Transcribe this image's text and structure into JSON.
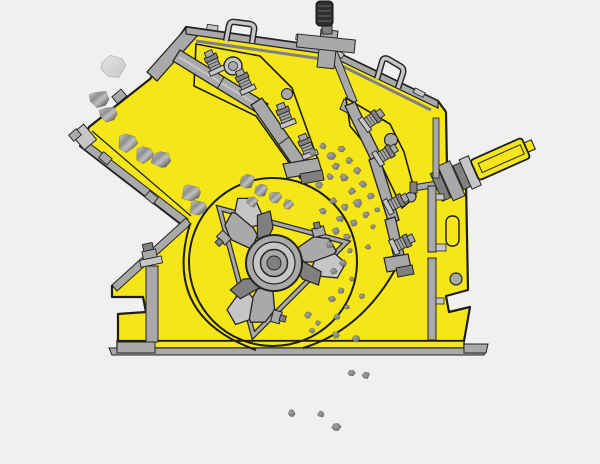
{
  "meta": {
    "description": "Cross-section technical illustration of an impact crusher: rocks feed in from the upper left chute, are struck by a three-hammer rotor against two suspended impact aprons, and crushed fines discharge below the machine.",
    "machine": "impact-crusher"
  },
  "colors": {
    "background": "#f0f0ee",
    "body_yellow": "#f5e619",
    "outline": "#1d1d1b",
    "metal": "#a9a9a9",
    "metal_light": "#c6c6c6",
    "metal_dark": "#808080",
    "grip": "#2e2e2e",
    "rock_light": "#cecece",
    "rock_mid": "#8f8f8f",
    "rock_hi": "#c0c0c0",
    "rock_dark": "#6b6b6b",
    "rock_faded_light": "#e2e2e2",
    "rock_faded_dark": "#c8c8c8",
    "pebble_light": "#a2a2a2",
    "pebble_dark": "#707070"
  },
  "rocks": {
    "feed": [
      [
        113,
        66,
        13,
        1
      ],
      [
        99,
        100,
        11
      ],
      [
        108,
        115,
        10
      ],
      [
        127,
        142,
        11
      ],
      [
        144,
        154,
        10
      ],
      [
        161,
        159,
        10
      ],
      [
        191,
        192,
        11
      ],
      [
        198,
        207,
        10
      ]
    ],
    "chamber": [
      [
        247,
        181,
        8
      ],
      [
        261,
        190,
        7
      ],
      [
        275,
        198,
        7
      ],
      [
        288,
        205,
        6
      ],
      [
        252,
        202,
        6
      ]
    ],
    "fines": [
      [
        313,
        152,
        4
      ],
      [
        323,
        146,
        4
      ],
      [
        332,
        156,
        5
      ],
      [
        342,
        149,
        4
      ],
      [
        336,
        166,
        4
      ],
      [
        349,
        161,
        4
      ],
      [
        357,
        171,
        4
      ],
      [
        344,
        178,
        5
      ],
      [
        330,
        177,
        4
      ],
      [
        319,
        185,
        4
      ],
      [
        352,
        191,
        4
      ],
      [
        363,
        184,
        4
      ],
      [
        371,
        196,
        4
      ],
      [
        358,
        203,
        5
      ],
      [
        345,
        207,
        4
      ],
      [
        333,
        201,
        4
      ],
      [
        323,
        211,
        4
      ],
      [
        340,
        219,
        4
      ],
      [
        354,
        223,
        4
      ],
      [
        366,
        215,
        4
      ],
      [
        373,
        227,
        3
      ],
      [
        347,
        237,
        4
      ],
      [
        336,
        231,
        4
      ],
      [
        330,
        245,
        4
      ],
      [
        350,
        251,
        3
      ],
      [
        343,
        263,
        4
      ],
      [
        334,
        271,
        4
      ],
      [
        352,
        279,
        3
      ],
      [
        341,
        291,
        4
      ],
      [
        332,
        299,
        4
      ],
      [
        347,
        307,
        3
      ],
      [
        337,
        317,
        4
      ],
      [
        308,
        315,
        4
      ],
      [
        318,
        323,
        3
      ],
      [
        336,
        335,
        4
      ],
      [
        356,
        339,
        4
      ],
      [
        312,
        331,
        3
      ],
      [
        362,
        296,
        3
      ],
      [
        368,
        247,
        3
      ],
      [
        377,
        210,
        3
      ]
    ],
    "discharge": [
      [
        292,
        413,
        4
      ],
      [
        321,
        414,
        4
      ],
      [
        337,
        427,
        5
      ],
      [
        352,
        373,
        4
      ],
      [
        366,
        375,
        4
      ]
    ]
  }
}
